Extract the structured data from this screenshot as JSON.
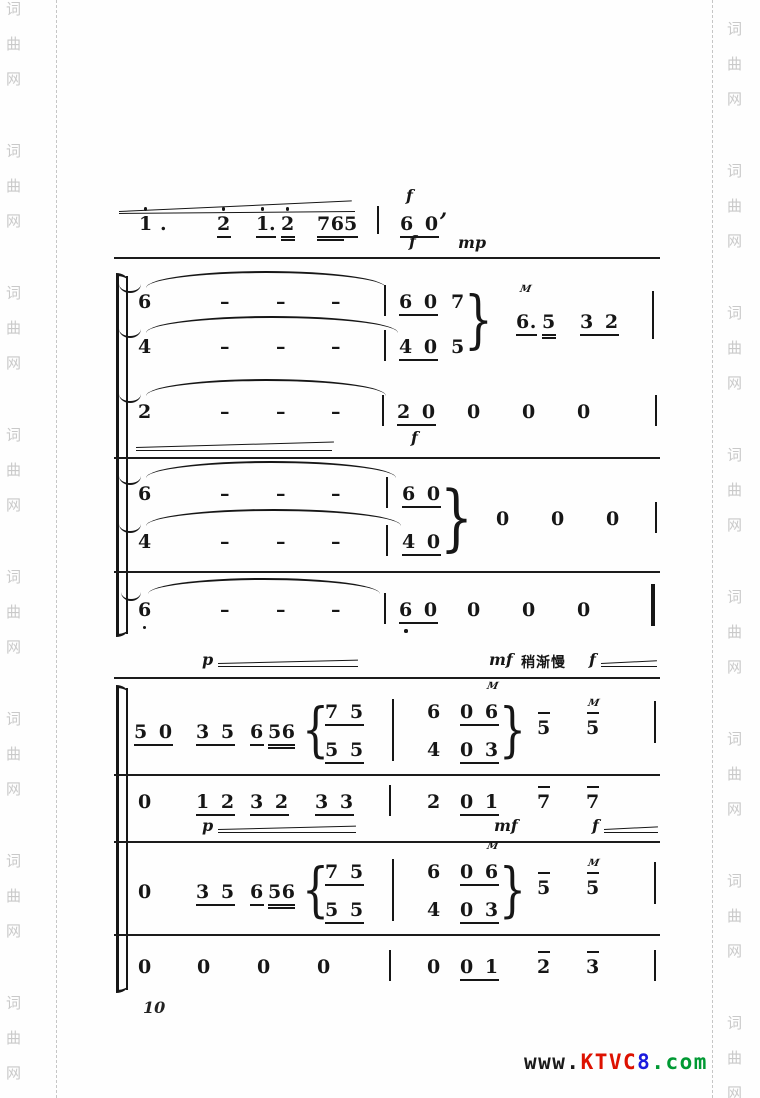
{
  "page_number": "10",
  "watermark": {
    "chars": [
      "词",
      "曲",
      "网"
    ],
    "left": {
      "x": 6,
      "start": 2,
      "period": 142,
      "gap": 35,
      "groups": 8
    },
    "right": {
      "x": 727,
      "start": 22,
      "period": 142,
      "gap": 35,
      "groups": 8
    },
    "dash_left_x": 56,
    "dash_right_x": 712
  },
  "logo": {
    "segments": [
      {
        "text": "www.",
        "color": "#1a1a1a"
      },
      {
        "text": "KTVC",
        "color": "#dd1100"
      },
      {
        "text": "8",
        "color": "#1a1add"
      },
      {
        "text": ".com",
        "color": "#009933"
      }
    ]
  },
  "score": {
    "items": [
      {
        "type": "line",
        "x": 119,
        "y": 211,
        "w": 233,
        "a": -2.6,
        "n": "crescendo-line"
      },
      {
        "type": "line",
        "x": 119,
        "y": 213,
        "w": 236,
        "a": -0.5,
        "n": "crescendo-line"
      },
      {
        "type": "note",
        "t": "1",
        "x": 139,
        "y": 213,
        "da": 1
      },
      {
        "type": "note",
        "t": ".",
        "x": 160,
        "y": 213
      },
      {
        "type": "note",
        "t": "2",
        "x": 217,
        "y": 213,
        "u": 1,
        "da": 1
      },
      {
        "type": "note",
        "t": "1",
        "x": 256,
        "y": 213,
        "u": 1,
        "da": 1
      },
      {
        "type": "note",
        "t": ".",
        "x": 269,
        "y": 213,
        "u": 1
      },
      {
        "type": "note",
        "t": "2",
        "x": 281,
        "y": 213,
        "u": 2,
        "da": 1
      },
      {
        "type": "note",
        "t": "76",
        "x": 317,
        "y": 213,
        "u": 2
      },
      {
        "type": "note",
        "t": "5",
        "x": 344,
        "y": 213,
        "u": 1
      },
      {
        "type": "bar",
        "x": 377,
        "y": 206,
        "h": 28
      },
      {
        "type": "text",
        "t": "f",
        "x": 406,
        "y": 186,
        "cls": "dyn"
      },
      {
        "type": "note",
        "t": "6 0",
        "x": 400,
        "y": 213,
        "u": 1
      },
      {
        "type": "note",
        "t": ",",
        "x": 440,
        "y": 198,
        "cls": "it",
        "n": "breath-mark"
      },
      {
        "type": "text",
        "t": "f",
        "x": 409,
        "y": 232,
        "cls": "dyn"
      },
      {
        "type": "text",
        "t": "mp",
        "x": 458,
        "y": 233,
        "cls": "dyn"
      },
      {
        "type": "sep",
        "x": 114,
        "y": 257,
        "w": 546
      },
      {
        "type": "bracket",
        "x": 116,
        "y": 276,
        "h": 358,
        "n": "system-bracket"
      },
      {
        "type": "bar",
        "x": 126,
        "y": 276,
        "h": 358,
        "w": 1.5
      },
      {
        "type": "arc",
        "x": 119,
        "y": 284,
        "w": 22,
        "h": 7,
        "flip": 1,
        "n": "tie-end"
      },
      {
        "type": "arc",
        "x": 146,
        "y": 271,
        "w": 240,
        "h": 15,
        "n": "slur"
      },
      {
        "type": "note",
        "t": "6",
        "x": 138,
        "y": 291
      },
      {
        "type": "note",
        "t": "–",
        "x": 220,
        "y": 291
      },
      {
        "type": "note",
        "t": "–",
        "x": 276,
        "y": 291
      },
      {
        "type": "note",
        "t": "–",
        "x": 331,
        "y": 291
      },
      {
        "type": "bar",
        "x": 384,
        "y": 285,
        "h": 31
      },
      {
        "type": "note",
        "t": "6 0",
        "x": 399,
        "y": 291,
        "u": 1
      },
      {
        "type": "note",
        "t": "7",
        "x": 451,
        "y": 291
      },
      {
        "type": "arc",
        "x": 119,
        "y": 329,
        "w": 22,
        "h": 7,
        "flip": 1,
        "n": "tie-end"
      },
      {
        "type": "arc",
        "x": 146,
        "y": 316,
        "w": 252,
        "h": 15,
        "n": "slur"
      },
      {
        "type": "note",
        "t": "4",
        "x": 138,
        "y": 336
      },
      {
        "type": "note",
        "t": "–",
        "x": 220,
        "y": 336
      },
      {
        "type": "note",
        "t": "–",
        "x": 276,
        "y": 336
      },
      {
        "type": "note",
        "t": "–",
        "x": 331,
        "y": 336
      },
      {
        "type": "bar",
        "x": 384,
        "y": 330,
        "h": 31
      },
      {
        "type": "note",
        "t": "4 0",
        "x": 399,
        "y": 336,
        "u": 1
      },
      {
        "type": "note",
        "t": "5",
        "x": 451,
        "y": 336
      },
      {
        "type": "brace",
        "t": "}",
        "x": 464,
        "y": 286,
        "h": 68
      },
      {
        "type": "text",
        "t": "M",
        "x": 520,
        "y": 284,
        "cls": "trem",
        "n": "tremolo-mark"
      },
      {
        "type": "note",
        "t": "6.",
        "x": 516,
        "y": 311,
        "u": 1
      },
      {
        "type": "note",
        "t": "5",
        "x": 542,
        "y": 311,
        "u": 2
      },
      {
        "type": "note",
        "t": "3 2",
        "x": 580,
        "y": 311,
        "u": 1
      },
      {
        "type": "bar",
        "x": 652,
        "y": 291,
        "h": 48
      },
      {
        "type": "arc",
        "x": 119,
        "y": 394,
        "w": 22,
        "h": 7,
        "flip": 1,
        "n": "tie-end"
      },
      {
        "type": "arc",
        "x": 146,
        "y": 379,
        "w": 240,
        "h": 15,
        "n": "slur"
      },
      {
        "type": "note",
        "t": "2",
        "x": 138,
        "y": 401
      },
      {
        "type": "note",
        "t": "–",
        "x": 220,
        "y": 401
      },
      {
        "type": "note",
        "t": "–",
        "x": 276,
        "y": 401
      },
      {
        "type": "note",
        "t": "–",
        "x": 331,
        "y": 401
      },
      {
        "type": "bar",
        "x": 382,
        "y": 395,
        "h": 31
      },
      {
        "type": "note",
        "t": "2 0",
        "x": 397,
        "y": 401,
        "u": 1
      },
      {
        "type": "note",
        "t": "0",
        "x": 467,
        "y": 401
      },
      {
        "type": "note",
        "t": "0",
        "x": 522,
        "y": 401
      },
      {
        "type": "note",
        "t": "0",
        "x": 577,
        "y": 401
      },
      {
        "type": "bar",
        "x": 655,
        "y": 395,
        "h": 31
      },
      {
        "type": "line",
        "x": 136,
        "y": 447,
        "w": 198,
        "a": -1.6,
        "n": "crescendo-line"
      },
      {
        "type": "line",
        "x": 136,
        "y": 450,
        "w": 196,
        "a": 0,
        "n": "crescendo-line"
      },
      {
        "type": "text",
        "t": "f",
        "x": 411,
        "y": 428,
        "cls": "dyn"
      },
      {
        "type": "sep",
        "x": 114,
        "y": 457,
        "w": 546
      },
      {
        "type": "arc",
        "x": 119,
        "y": 476,
        "w": 22,
        "h": 7,
        "flip": 1,
        "n": "tie-end"
      },
      {
        "type": "arc",
        "x": 146,
        "y": 461,
        "w": 250,
        "h": 15,
        "n": "slur"
      },
      {
        "type": "note",
        "t": "6",
        "x": 138,
        "y": 483
      },
      {
        "type": "note",
        "t": "–",
        "x": 220,
        "y": 483
      },
      {
        "type": "note",
        "t": "–",
        "x": 276,
        "y": 483
      },
      {
        "type": "note",
        "t": "–",
        "x": 331,
        "y": 483
      },
      {
        "type": "bar",
        "x": 386,
        "y": 477,
        "h": 31
      },
      {
        "type": "note",
        "t": "6 0",
        "x": 402,
        "y": 483,
        "u": 1
      },
      {
        "type": "arc",
        "x": 119,
        "y": 524,
        "w": 22,
        "h": 7,
        "flip": 1,
        "n": "tie-end"
      },
      {
        "type": "arc",
        "x": 146,
        "y": 509,
        "w": 255,
        "h": 15,
        "n": "slur"
      },
      {
        "type": "note",
        "t": "4",
        "x": 138,
        "y": 531
      },
      {
        "type": "note",
        "t": "–",
        "x": 220,
        "y": 531
      },
      {
        "type": "note",
        "t": "–",
        "x": 276,
        "y": 531
      },
      {
        "type": "note",
        "t": "–",
        "x": 331,
        "y": 531
      },
      {
        "type": "bar",
        "x": 386,
        "y": 525,
        "h": 31
      },
      {
        "type": "note",
        "t": "4 0",
        "x": 402,
        "y": 531,
        "u": 1
      },
      {
        "type": "brace",
        "t": "}",
        "x": 440,
        "y": 478,
        "h": 78
      },
      {
        "type": "note",
        "t": "0",
        "x": 496,
        "y": 508
      },
      {
        "type": "note",
        "t": "0",
        "x": 551,
        "y": 508
      },
      {
        "type": "note",
        "t": "0",
        "x": 606,
        "y": 508
      },
      {
        "type": "bar",
        "x": 655,
        "y": 502,
        "h": 31
      },
      {
        "type": "sep",
        "x": 114,
        "y": 571,
        "w": 546
      },
      {
        "type": "arc",
        "x": 121,
        "y": 592,
        "w": 20,
        "h": 7,
        "flip": 1,
        "n": "tie-end"
      },
      {
        "type": "arc",
        "x": 148,
        "y": 578,
        "w": 232,
        "h": 14,
        "n": "slur"
      },
      {
        "type": "note",
        "t": "6",
        "x": 138,
        "y": 599,
        "db": 1
      },
      {
        "type": "note",
        "t": "–",
        "x": 220,
        "y": 599
      },
      {
        "type": "note",
        "t": "–",
        "x": 276,
        "y": 599
      },
      {
        "type": "note",
        "t": "–",
        "x": 331,
        "y": 599
      },
      {
        "type": "bar",
        "x": 384,
        "y": 593,
        "h": 31
      },
      {
        "type": "note",
        "t": "6 0",
        "x": 399,
        "y": 599,
        "u": 1
      },
      {
        "type": "dot",
        "x": 404,
        "y": 629,
        "n": "octave-dot"
      },
      {
        "type": "note",
        "t": "0",
        "x": 467,
        "y": 599
      },
      {
        "type": "note",
        "t": "0",
        "x": 522,
        "y": 599
      },
      {
        "type": "note",
        "t": "0",
        "x": 577,
        "y": 599
      },
      {
        "type": "bar",
        "x": 651,
        "y": 584,
        "h": 42,
        "w": 4
      },
      {
        "type": "text",
        "t": "p",
        "x": 202,
        "y": 650,
        "cls": "dyn"
      },
      {
        "type": "line",
        "x": 218,
        "y": 663,
        "w": 140,
        "a": -1.4,
        "n": "crescendo-line"
      },
      {
        "type": "line",
        "x": 218,
        "y": 666,
        "w": 140,
        "a": 0,
        "n": "crescendo-line"
      },
      {
        "type": "text",
        "t": "mf",
        "x": 489,
        "y": 650,
        "cls": "dyn"
      },
      {
        "type": "text",
        "t": "稍渐慢",
        "x": 521,
        "y": 652,
        "cls": "cjk",
        "n": "tempo-text"
      },
      {
        "type": "text",
        "t": "f",
        "x": 589,
        "y": 650,
        "cls": "dyn"
      },
      {
        "type": "line",
        "x": 601,
        "y": 663,
        "w": 56,
        "a": -2.8,
        "n": "crescendo-line"
      },
      {
        "type": "line",
        "x": 601,
        "y": 666,
        "w": 56,
        "a": 0,
        "n": "crescendo-line"
      },
      {
        "type": "sep",
        "x": 114,
        "y": 677,
        "w": 546
      },
      {
        "type": "bracket",
        "x": 116,
        "y": 688,
        "h": 302,
        "n": "system-bracket"
      },
      {
        "type": "bar",
        "x": 126,
        "y": 688,
        "h": 302,
        "w": 1.5
      },
      {
        "type": "note",
        "t": "5 0",
        "x": 134,
        "y": 721,
        "u": 1
      },
      {
        "type": "note",
        "t": "3 5",
        "x": 196,
        "y": 721,
        "u": 1
      },
      {
        "type": "note",
        "t": "6",
        "x": 250,
        "y": 721,
        "u": 1
      },
      {
        "type": "note",
        "t": "56",
        "x": 268,
        "y": 721,
        "u": 2
      },
      {
        "type": "brace",
        "t": "{",
        "x": 302,
        "y": 698,
        "h": 64
      },
      {
        "type": "note",
        "t": "7 5",
        "x": 325,
        "y": 701,
        "u": 1
      },
      {
        "type": "note",
        "t": "5 5",
        "x": 325,
        "y": 739,
        "u": 1
      },
      {
        "type": "bar",
        "x": 392,
        "y": 699,
        "h": 62
      },
      {
        "type": "note",
        "t": "6",
        "x": 427,
        "y": 701
      },
      {
        "type": "note",
        "t": "4",
        "x": 427,
        "y": 739
      },
      {
        "type": "text",
        "t": "M",
        "x": 487,
        "y": 681,
        "cls": "trem",
        "n": "tremolo-mark"
      },
      {
        "type": "note",
        "t": "0 6",
        "x": 460,
        "y": 701,
        "u": 1
      },
      {
        "type": "note",
        "t": "0 3",
        "x": 460,
        "y": 739,
        "u": 1
      },
      {
        "type": "brace",
        "t": "}",
        "x": 499,
        "y": 698,
        "h": 64
      },
      {
        "type": "note",
        "t": "5",
        "x": 537,
        "y": 717,
        "ov": 1
      },
      {
        "type": "text",
        "t": "M",
        "x": 588,
        "y": 698,
        "cls": "trem",
        "n": "tremolo-mark"
      },
      {
        "type": "note",
        "t": "5",
        "x": 586,
        "y": 717,
        "ov": 1
      },
      {
        "type": "bar",
        "x": 654,
        "y": 701,
        "h": 42
      },
      {
        "type": "sep",
        "x": 114,
        "y": 774,
        "w": 546
      },
      {
        "type": "note",
        "t": "0",
        "x": 138,
        "y": 791
      },
      {
        "type": "note",
        "t": "1 2",
        "x": 196,
        "y": 791,
        "u": 1
      },
      {
        "type": "note",
        "t": "3 2",
        "x": 250,
        "y": 791,
        "u": 1
      },
      {
        "type": "note",
        "t": "3 3",
        "x": 315,
        "y": 791,
        "u": 1
      },
      {
        "type": "bar",
        "x": 389,
        "y": 785,
        "h": 31
      },
      {
        "type": "note",
        "t": "2",
        "x": 427,
        "y": 791
      },
      {
        "type": "note",
        "t": "0 1",
        "x": 460,
        "y": 791,
        "u": 1
      },
      {
        "type": "note",
        "t": "7",
        "x": 537,
        "y": 791,
        "ov": 1
      },
      {
        "type": "note",
        "t": "7",
        "x": 586,
        "y": 791,
        "ov": 1
      },
      {
        "type": "text",
        "t": "p",
        "x": 202,
        "y": 816,
        "cls": "dyn"
      },
      {
        "type": "line",
        "x": 218,
        "y": 829,
        "w": 138,
        "a": -1.4,
        "n": "crescendo-line"
      },
      {
        "type": "line",
        "x": 218,
        "y": 832,
        "w": 138,
        "a": 0,
        "n": "crescendo-line"
      },
      {
        "type": "text",
        "t": "mf",
        "x": 494,
        "y": 816,
        "cls": "dyn"
      },
      {
        "type": "text",
        "t": "f",
        "x": 592,
        "y": 816,
        "cls": "dyn"
      },
      {
        "type": "line",
        "x": 604,
        "y": 829,
        "w": 54,
        "a": -2.8,
        "n": "crescendo-line"
      },
      {
        "type": "line",
        "x": 604,
        "y": 832,
        "w": 54,
        "a": 0,
        "n": "crescendo-line"
      },
      {
        "type": "sep",
        "x": 114,
        "y": 841,
        "w": 546
      },
      {
        "type": "note",
        "t": "0",
        "x": 138,
        "y": 881
      },
      {
        "type": "note",
        "t": "3 5",
        "x": 196,
        "y": 881,
        "u": 1
      },
      {
        "type": "note",
        "t": "6",
        "x": 250,
        "y": 881,
        "u": 1
      },
      {
        "type": "note",
        "t": "56",
        "x": 268,
        "y": 881,
        "u": 2
      },
      {
        "type": "brace",
        "t": "{",
        "x": 302,
        "y": 858,
        "h": 64
      },
      {
        "type": "note",
        "t": "7 5",
        "x": 325,
        "y": 861,
        "u": 1
      },
      {
        "type": "note",
        "t": "5 5",
        "x": 325,
        "y": 899,
        "u": 1
      },
      {
        "type": "bar",
        "x": 392,
        "y": 859,
        "h": 62
      },
      {
        "type": "note",
        "t": "6",
        "x": 427,
        "y": 861
      },
      {
        "type": "note",
        "t": "4",
        "x": 427,
        "y": 899
      },
      {
        "type": "text",
        "t": "M",
        "x": 487,
        "y": 841,
        "cls": "trem",
        "n": "tremolo-mark"
      },
      {
        "type": "note",
        "t": "0 6",
        "x": 460,
        "y": 861,
        "u": 1
      },
      {
        "type": "note",
        "t": "0 3",
        "x": 460,
        "y": 899,
        "u": 1
      },
      {
        "type": "brace",
        "t": "}",
        "x": 499,
        "y": 858,
        "h": 64
      },
      {
        "type": "note",
        "t": "5",
        "x": 537,
        "y": 877,
        "ov": 1
      },
      {
        "type": "text",
        "t": "M",
        "x": 588,
        "y": 858,
        "cls": "trem",
        "n": "tremolo-mark"
      },
      {
        "type": "note",
        "t": "5",
        "x": 586,
        "y": 877,
        "ov": 1
      },
      {
        "type": "bar",
        "x": 654,
        "y": 862,
        "h": 42
      },
      {
        "type": "sep",
        "x": 114,
        "y": 934,
        "w": 546
      },
      {
        "type": "note",
        "t": "0",
        "x": 138,
        "y": 956
      },
      {
        "type": "note",
        "t": "0",
        "x": 197,
        "y": 956
      },
      {
        "type": "note",
        "t": "0",
        "x": 257,
        "y": 956
      },
      {
        "type": "note",
        "t": "0",
        "x": 317,
        "y": 956
      },
      {
        "type": "bar",
        "x": 389,
        "y": 950,
        "h": 31
      },
      {
        "type": "note",
        "t": "0",
        "x": 427,
        "y": 956
      },
      {
        "type": "note",
        "t": "0 1",
        "x": 460,
        "y": 956,
        "u": 1
      },
      {
        "type": "note",
        "t": "2",
        "x": 537,
        "y": 956,
        "ov": 1
      },
      {
        "type": "note",
        "t": "3",
        "x": 586,
        "y": 956,
        "ov": 1
      },
      {
        "type": "bar",
        "x": 654,
        "y": 950,
        "h": 31
      }
    ]
  }
}
